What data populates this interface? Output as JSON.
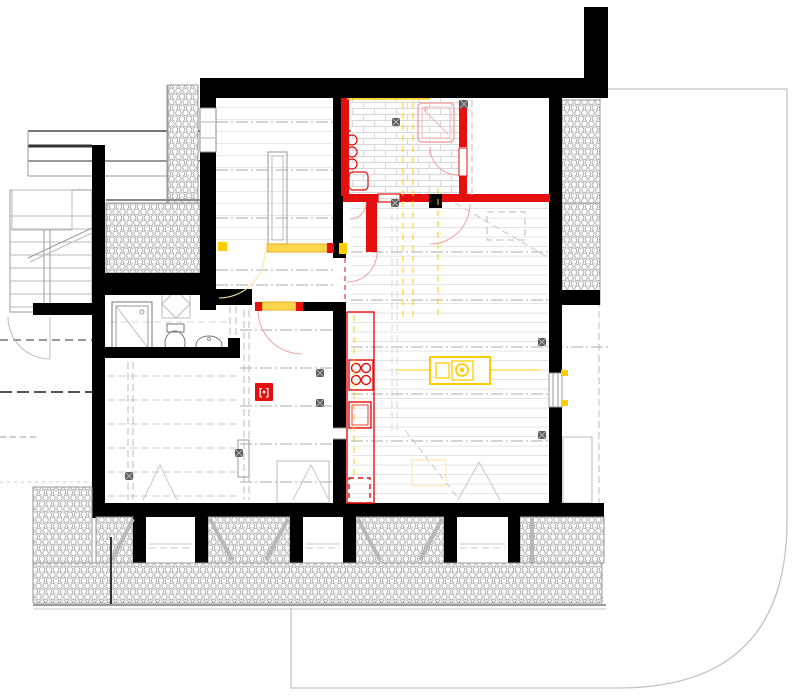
{
  "canvas": {
    "width": 804,
    "height": 700,
    "background": "#ffffff"
  },
  "palette": {
    "wall-black": "#000000",
    "new-wall-red": "#e60f0f",
    "door-arc-red": "#f0a8a8",
    "services-yellow": "#ffcc00",
    "threshold-fill": "#ffd54d",
    "threshold-edge": "#e8a000",
    "hatch-stroke": "#9a9a9a",
    "hatch-fill": "#f4f4f4",
    "floor-line": "#dedede",
    "gridline-gray": "#ababab",
    "fixture-gray": "#8a8a8a",
    "boundary-gray": "#c4c4c4",
    "foundation-splay": "#b8b8b8",
    "marker-bg": "#e60f0f",
    "marker-fg": "#ffffff"
  },
  "marker": {
    "glyph": "[•]"
  }
}
